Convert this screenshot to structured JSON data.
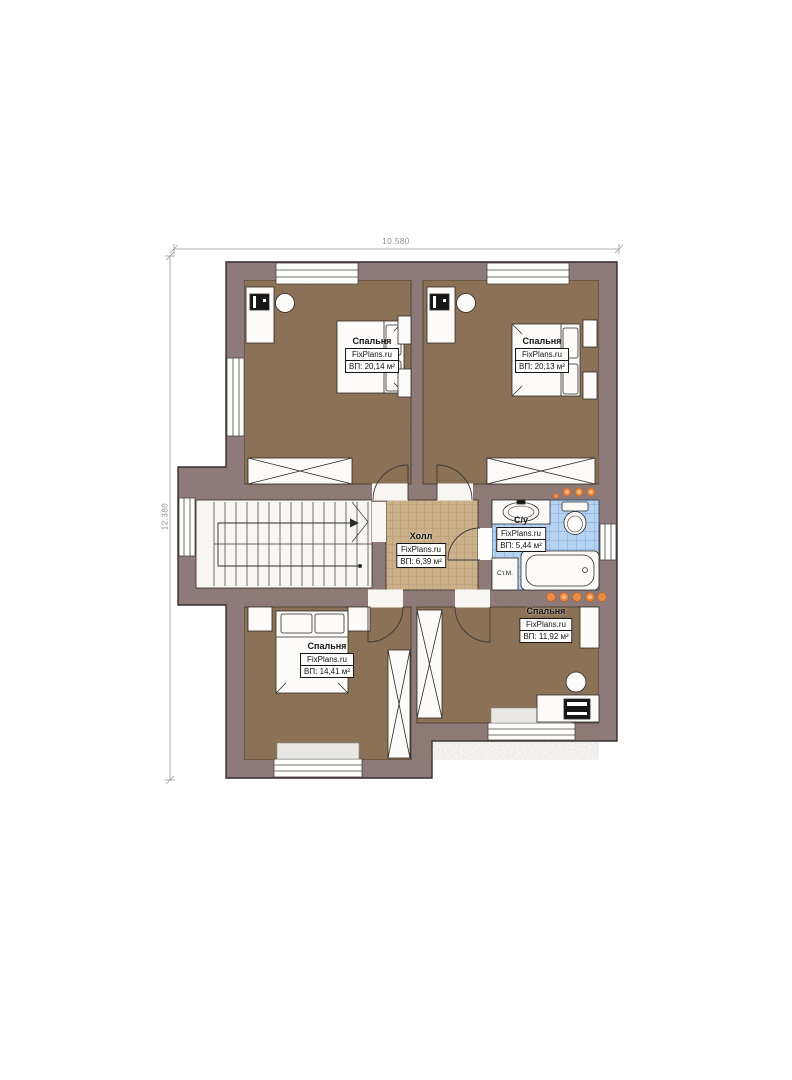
{
  "plan": {
    "brand": "FixPlans.ru",
    "dimensions": {
      "width": "10.580",
      "height": "12.380"
    },
    "rooms": [
      {
        "id": "bedroom-top-left",
        "name": "Спальня",
        "brand": "FixPlans.ru",
        "area": "ВП: 20,14 м²"
      },
      {
        "id": "bedroom-top-right",
        "name": "Спальня",
        "brand": "FixPlans.ru",
        "area": "ВП: 20,13 м²"
      },
      {
        "id": "hall",
        "name": "Холл",
        "brand": "FixPlans.ru",
        "area": "ВП: 6,39 м²"
      },
      {
        "id": "bathroom",
        "name": "С/у",
        "brand": "FixPlans.ru",
        "area": "ВП: 5,44 м²"
      },
      {
        "id": "bedroom-bottom-left",
        "name": "Спальня",
        "brand": "FixPlans.ru",
        "area": "ВП: 14,41 м²"
      },
      {
        "id": "bedroom-bottom-right",
        "name": "Спальня",
        "brand": "FixPlans.ru",
        "area": "ВП: 11,92 м²"
      }
    ],
    "labels": {
      "washing_machine": "Ст.М."
    },
    "colors": {
      "wall": "#8e7a7a",
      "bedroom_floor": "#8b7157",
      "hall_floor": "#cbb18a",
      "bathroom_tile": "#b7d3f2",
      "radiator": "#ea8a45",
      "furniture": "#fcfbf9"
    }
  }
}
